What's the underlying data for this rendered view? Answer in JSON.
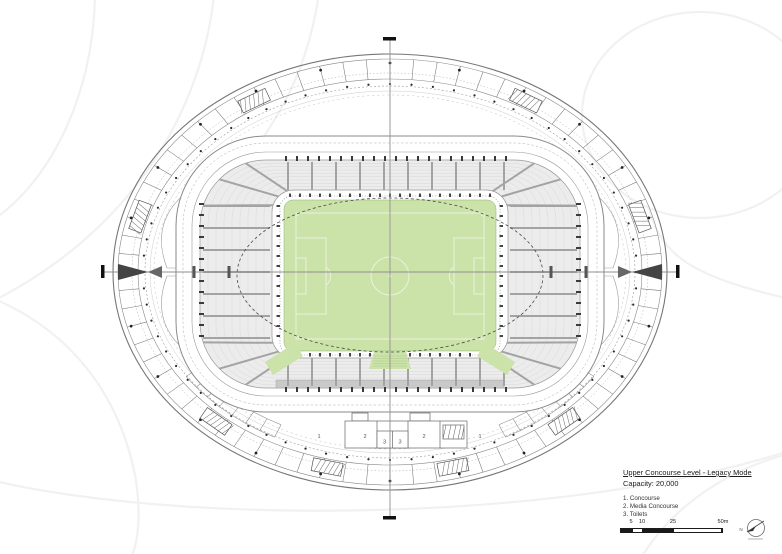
{
  "sheet": {
    "title_block": {
      "title": "Upper Concourse Level - Legacy Mode",
      "capacity": "Capacity: 20,000",
      "legend": [
        "1. Concourse",
        "2. Media Concourse",
        "3. Toilets"
      ]
    },
    "scale_bar": {
      "labels": [
        "5",
        "10",
        "25",
        "50m"
      ]
    },
    "north_label": "N",
    "plan": {
      "room_labels": [
        "1",
        "2",
        "3",
        "3",
        "2",
        "1"
      ]
    },
    "colors": {
      "pitch": "#cbe2a9",
      "pitch_line": "#e8f1d8",
      "pitch_edge": "#8faf74",
      "seating": "#ececec",
      "seating_row": "#d9d9d9",
      "aisle": "#a3a3a3",
      "band_dark": "#c9c9c9",
      "ring": "#777777",
      "dark": "#2a2a2a",
      "axis": "#8f8f8f",
      "contour": "#f1f1f1"
    }
  }
}
